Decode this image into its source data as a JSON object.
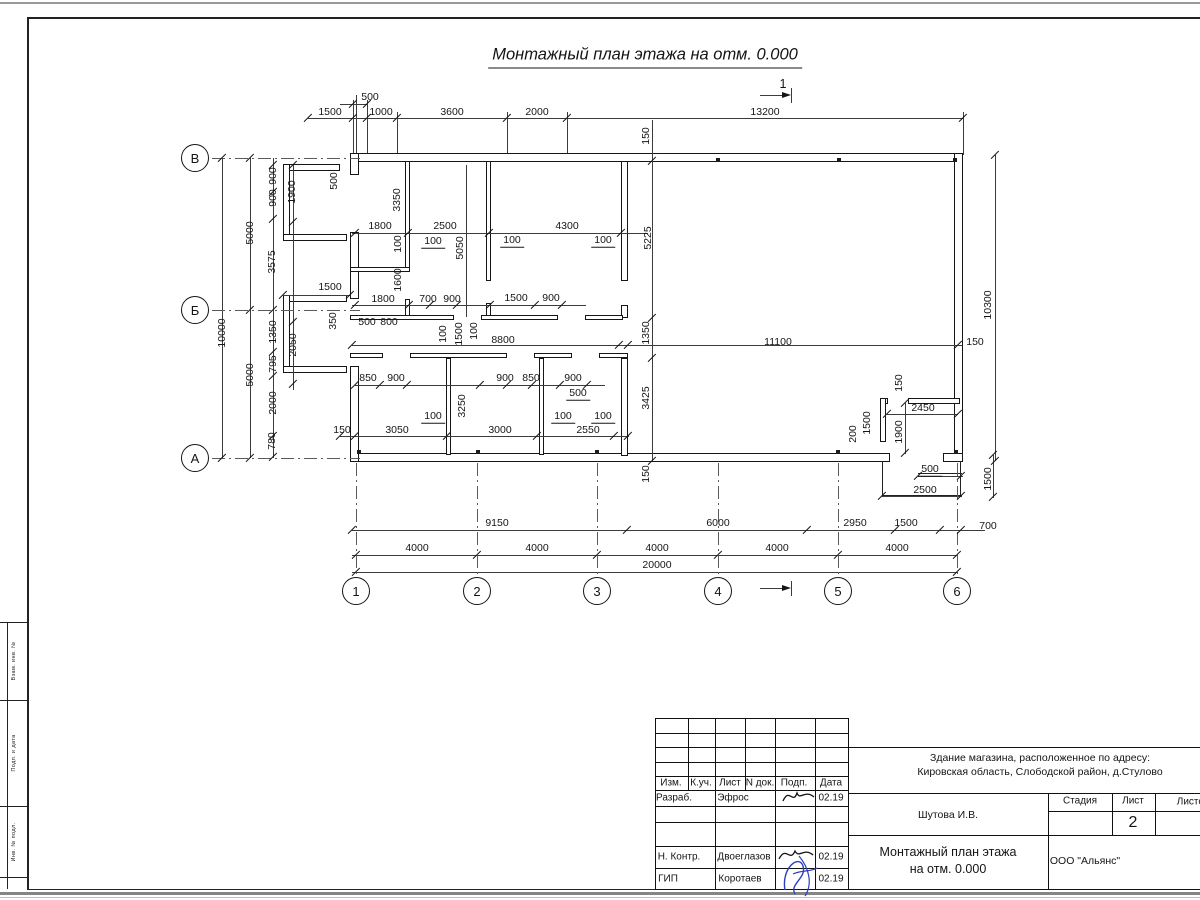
{
  "sheet": {
    "title": "Монтажный план этажа на отм. 0.000",
    "section_label": "1"
  },
  "axes": {
    "rows": [
      "В",
      "Б",
      "А"
    ],
    "cols": [
      "1",
      "2",
      "3",
      "4",
      "5",
      "6"
    ]
  },
  "dimensions": [
    {
      "t": "500",
      "x": 370,
      "y": 97
    },
    {
      "t": "1500",
      "x": 330,
      "y": 112
    },
    {
      "t": "1000",
      "x": 381,
      "y": 112
    },
    {
      "t": "3600",
      "x": 452,
      "y": 112
    },
    {
      "t": "2000",
      "x": 537,
      "y": 112
    },
    {
      "t": "13200",
      "x": 765,
      "y": 112
    },
    {
      "t": "150",
      "x": 646,
      "y": 136,
      "r": 1
    },
    {
      "t": "900",
      "x": 273,
      "y": 176,
      "r": 1
    },
    {
      "t": "900",
      "x": 273,
      "y": 198,
      "r": 1
    },
    {
      "t": "1900",
      "x": 292,
      "y": 192,
      "r": 1
    },
    {
      "t": "500",
      "x": 334,
      "y": 181,
      "r": 1
    },
    {
      "t": "5000",
      "x": 250,
      "y": 233,
      "r": 1
    },
    {
      "t": "3575",
      "x": 272,
      "y": 262,
      "r": 1
    },
    {
      "t": "10000",
      "x": 222,
      "y": 333,
      "r": 1
    },
    {
      "t": "5000",
      "x": 250,
      "y": 375,
      "r": 1
    },
    {
      "t": "1350",
      "x": 273,
      "y": 332,
      "r": 1
    },
    {
      "t": "2050",
      "x": 293,
      "y": 345,
      "r": 1
    },
    {
      "t": "795",
      "x": 273,
      "y": 364,
      "r": 1
    },
    {
      "t": "2000",
      "x": 273,
      "y": 403,
      "r": 1
    },
    {
      "t": "780",
      "x": 272,
      "y": 441,
      "r": 1
    },
    {
      "t": "350",
      "x": 333,
      "y": 321,
      "r": 1
    },
    {
      "t": "1500",
      "x": 330,
      "y": 287
    },
    {
      "t": "150",
      "x": 342,
      "y": 430
    },
    {
      "t": "3350",
      "x": 397,
      "y": 200,
      "r": 1
    },
    {
      "t": "1800",
      "x": 380,
      "y": 226
    },
    {
      "t": "2500",
      "x": 445,
      "y": 226
    },
    {
      "t": "4300",
      "x": 567,
      "y": 226
    },
    {
      "t": "100",
      "x": 433,
      "y": 242,
      "u": 1
    },
    {
      "t": "100",
      "x": 512,
      "y": 241,
      "u": 1
    },
    {
      "t": "100",
      "x": 603,
      "y": 241,
      "u": 1
    },
    {
      "t": "5050",
      "x": 460,
      "y": 248,
      "r": 1
    },
    {
      "t": "5225",
      "x": 648,
      "y": 238,
      "r": 1
    },
    {
      "t": "100",
      "x": 398,
      "y": 244,
      "r": 1
    },
    {
      "t": "1600",
      "x": 398,
      "y": 280,
      "r": 1
    },
    {
      "t": "1800",
      "x": 383,
      "y": 299
    },
    {
      "t": "700",
      "x": 428,
      "y": 299
    },
    {
      "t": "900",
      "x": 452,
      "y": 299
    },
    {
      "t": "1500",
      "x": 516,
      "y": 298
    },
    {
      "t": "900",
      "x": 551,
      "y": 298
    },
    {
      "t": "500",
      "x": 367,
      "y": 322
    },
    {
      "t": "800",
      "x": 389,
      "y": 322
    },
    {
      "t": "100",
      "x": 443,
      "y": 334,
      "r": 1
    },
    {
      "t": "1500",
      "x": 459,
      "y": 334,
      "r": 1
    },
    {
      "t": "100",
      "x": 474,
      "y": 331,
      "r": 1
    },
    {
      "t": "8800",
      "x": 503,
      "y": 340
    },
    {
      "t": "1350",
      "x": 646,
      "y": 333,
      "r": 1
    },
    {
      "t": "11100",
      "x": 778,
      "y": 342
    },
    {
      "t": "150",
      "x": 975,
      "y": 342
    },
    {
      "t": "10300",
      "x": 988,
      "y": 305,
      "r": 1
    },
    {
      "t": "850",
      "x": 368,
      "y": 378
    },
    {
      "t": "900",
      "x": 396,
      "y": 378
    },
    {
      "t": "900",
      "x": 505,
      "y": 378
    },
    {
      "t": "850",
      "x": 531,
      "y": 378
    },
    {
      "t": "900",
      "x": 573,
      "y": 378
    },
    {
      "t": "500",
      "x": 578,
      "y": 394,
      "u": 1
    },
    {
      "t": "3250",
      "x": 462,
      "y": 406,
      "r": 1
    },
    {
      "t": "3425",
      "x": 646,
      "y": 398,
      "r": 1
    },
    {
      "t": "100",
      "x": 433,
      "y": 417,
      "u": 1
    },
    {
      "t": "100",
      "x": 563,
      "y": 417,
      "u": 1
    },
    {
      "t": "100",
      "x": 603,
      "y": 417,
      "u": 1
    },
    {
      "t": "3050",
      "x": 397,
      "y": 430
    },
    {
      "t": "3000",
      "x": 500,
      "y": 430
    },
    {
      "t": "2550",
      "x": 588,
      "y": 430
    },
    {
      "t": "150",
      "x": 646,
      "y": 474,
      "r": 1
    },
    {
      "t": "150",
      "x": 899,
      "y": 383,
      "r": 1
    },
    {
      "t": "2450",
      "x": 923,
      "y": 408
    },
    {
      "t": "1500",
      "x": 867,
      "y": 423,
      "r": 1
    },
    {
      "t": "1900",
      "x": 899,
      "y": 432,
      "r": 1
    },
    {
      "t": "200",
      "x": 853,
      "y": 434,
      "r": 1
    },
    {
      "t": "500",
      "x": 930,
      "y": 470,
      "u": 1
    },
    {
      "t": "2500",
      "x": 925,
      "y": 490
    },
    {
      "t": "1500",
      "x": 988,
      "y": 479,
      "r": 1
    },
    {
      "t": "700",
      "x": 988,
      "y": 526
    },
    {
      "t": "9150",
      "x": 497,
      "y": 523
    },
    {
      "t": "6000",
      "x": 718,
      "y": 523
    },
    {
      "t": "2950",
      "x": 855,
      "y": 523
    },
    {
      "t": "1500",
      "x": 906,
      "y": 523
    },
    {
      "t": "4000",
      "x": 417,
      "y": 548
    },
    {
      "t": "4000",
      "x": 537,
      "y": 548
    },
    {
      "t": "4000",
      "x": 657,
      "y": 548
    },
    {
      "t": "4000",
      "x": 777,
      "y": 548
    },
    {
      "t": "4000",
      "x": 897,
      "y": 548
    },
    {
      "t": "20000",
      "x": 657,
      "y": 565
    }
  ],
  "title_block": {
    "project_line1": "Здание магазина, расположенное по адресу:",
    "project_line2": "Кировская область, Слободской район, д.Стулово",
    "chief": "Шутова И.В.",
    "doc_title_line1": "Монтажный план этажа",
    "doc_title_line2": "на отм. 0.000",
    "company": "ООО \"Альянс\"",
    "stage_label": "Стадия",
    "sheet_label": "Лист",
    "sheets_label": "Листов",
    "sheet_number": "2",
    "header_cells": [
      "Изм.",
      "К.уч.",
      "Лист",
      "N док.",
      "Подп.",
      "Дата"
    ],
    "rows": [
      {
        "role": "Разраб.",
        "name": "Эфрос",
        "date": "02.19"
      },
      {
        "role": "Н. Контр.",
        "name": "Двоеглазов",
        "date": "02.19"
      },
      {
        "role": "ГИП",
        "name": "Коротаев",
        "date": "02.19"
      }
    ]
  },
  "left_margin": {
    "labels": [
      "Взам. инв. №",
      "Подп. и дата",
      "Инв. № подл."
    ]
  }
}
